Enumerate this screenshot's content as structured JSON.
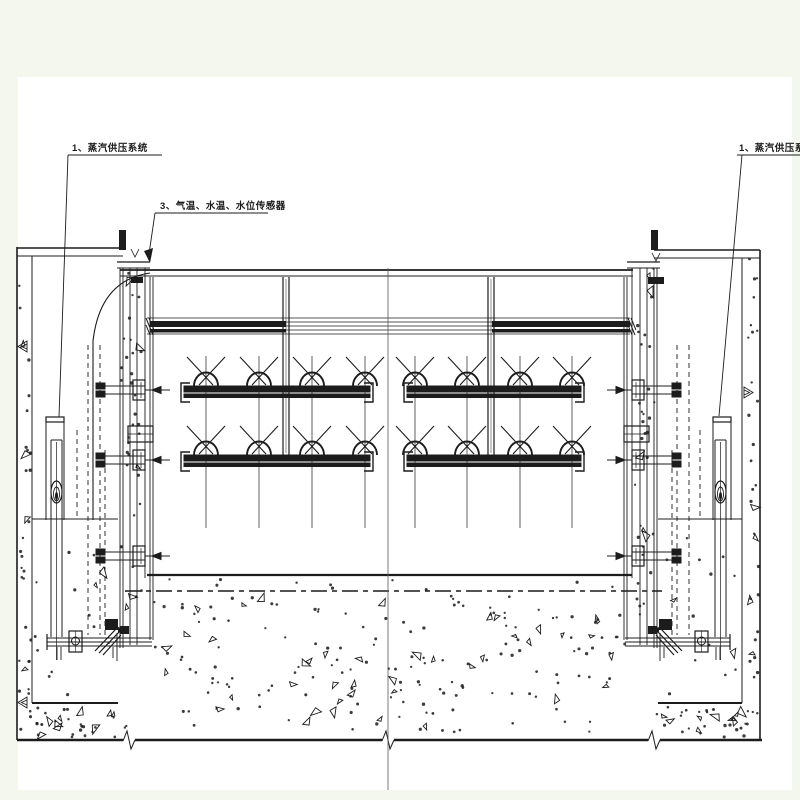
{
  "drawing": {
    "type": "engineering-cad-section",
    "title_hint": "gate steam/spray system cross-section",
    "labels": {
      "steam_left": "1、蒸汽供压系统",
      "sensors": "3、气温、水温、水位传感器",
      "steam_right": "1、蒸汽供压系统"
    },
    "colors": {
      "ink": "#1c1c1c",
      "sheet": "#ffffff",
      "margin": "#f4f7ee",
      "centerline": "#5a5a5a"
    },
    "centerline_x": 388,
    "nozzles": {
      "pipe_tops": [
        386,
        455
      ],
      "sides": [
        {
          "x1": 181,
          "x2": 373,
          "centers": [
            206,
            259,
            312,
            365
          ]
        },
        {
          "x1": 404,
          "x2": 584,
          "centers": [
            415,
            467,
            520,
            572
          ]
        }
      ]
    },
    "stipple_seed": 11
  }
}
